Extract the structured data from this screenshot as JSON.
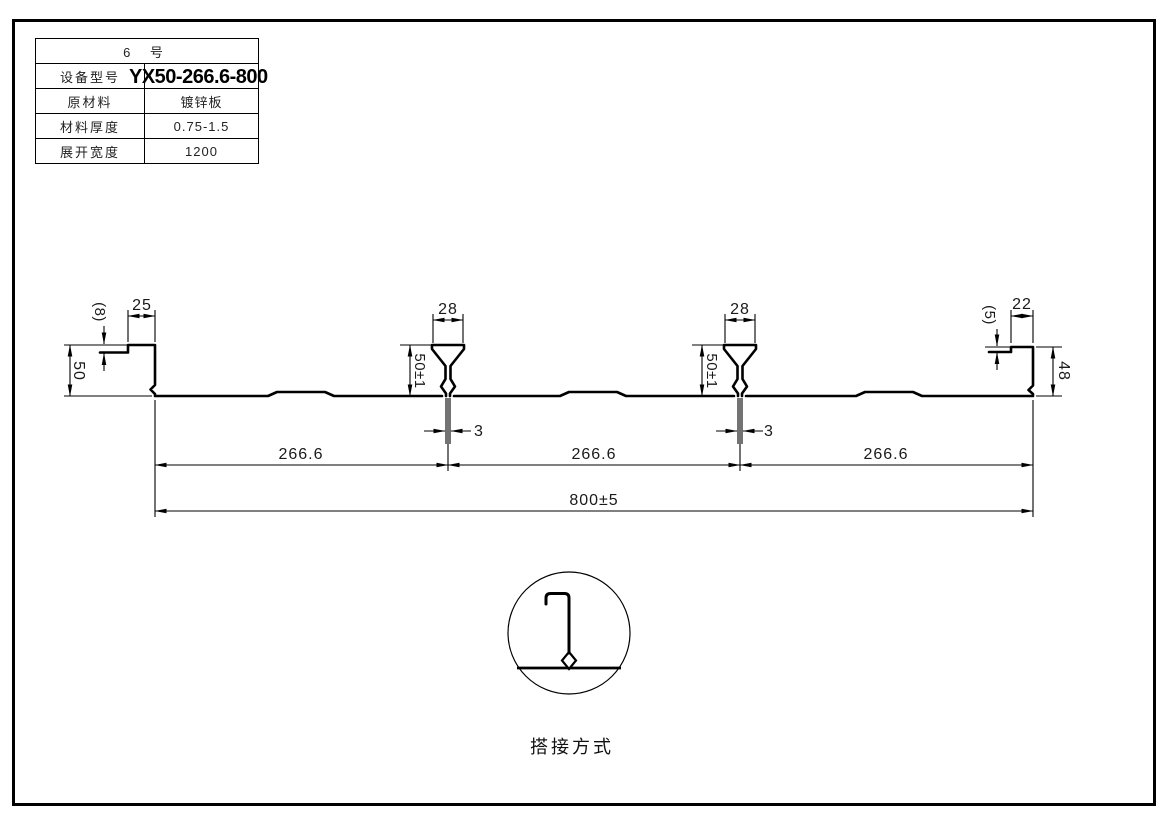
{
  "page": {
    "background": "#ffffff",
    "line_color": "#000000"
  },
  "spec_table": {
    "header": "6 号",
    "rows": [
      {
        "label": "设备型号",
        "value": "YX50-266.6-800"
      },
      {
        "label": "原材料",
        "value": "镀锌板"
      },
      {
        "label": "材料厚度",
        "value": "0.75-1.5"
      },
      {
        "label": "展开宽度",
        "value": "1200"
      }
    ]
  },
  "profile": {
    "dims": {
      "left_lip_offset": "(8)",
      "left_flange_width": "25",
      "left_height": "50",
      "rib_top_width": "28",
      "rib_height": "50±1",
      "rib_slot_width": "3",
      "pitch": "266.6",
      "overall_width": "800±5",
      "right_lip_offset": "(5)",
      "right_flange_width": "22",
      "right_height": "48"
    }
  },
  "detail": {
    "caption": "搭接方式"
  }
}
